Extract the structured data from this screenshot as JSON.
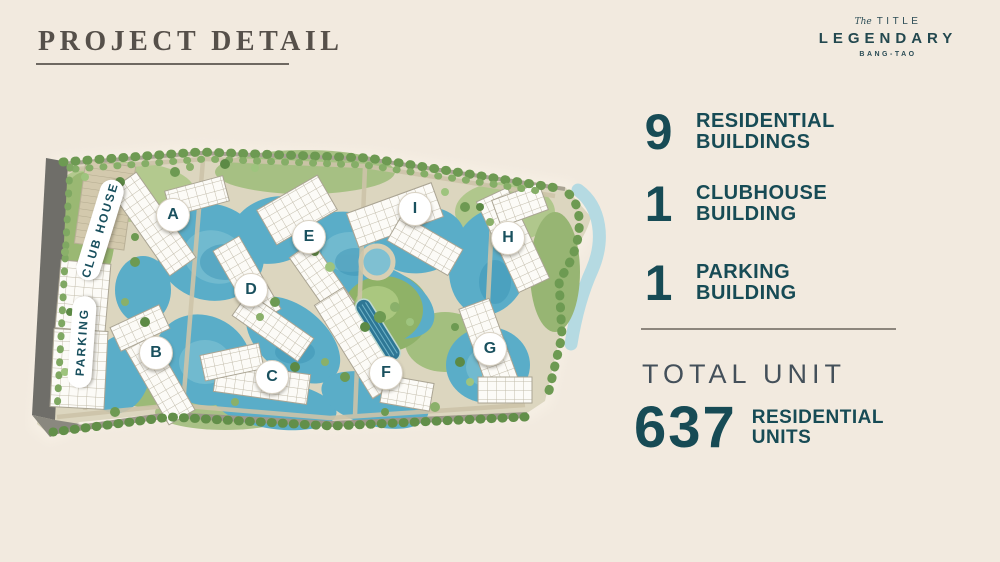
{
  "header": {
    "title": "PROJECT DETAIL"
  },
  "logo": {
    "brand_script": "The",
    "brand_name": "TITLE",
    "project_name": "LEGENDARY",
    "location": "BANG-TAO"
  },
  "map": {
    "buildings": [
      {
        "label": "A"
      },
      {
        "label": "B"
      },
      {
        "label": "C"
      },
      {
        "label": "D"
      },
      {
        "label": "E"
      },
      {
        "label": "F"
      },
      {
        "label": "G"
      },
      {
        "label": "H"
      },
      {
        "label": "I"
      }
    ],
    "facilities": [
      {
        "label": "CLUB HOUSE"
      },
      {
        "label": "PARKING"
      }
    ]
  },
  "stats": {
    "items": [
      {
        "value": "9",
        "line1": "RESIDENTIAL",
        "line2": "BUILDINGS"
      },
      {
        "value": "1",
        "line1": "CLUBHOUSE",
        "line2": "BUILDING"
      },
      {
        "value": "1",
        "line1": "PARKING",
        "line2": "BUILDING"
      }
    ],
    "total_label": "TOTAL UNIT",
    "total": {
      "value": "637",
      "line1": "RESIDENTIAL",
      "line2": "UNITS"
    }
  },
  "colors": {
    "background": "#f2eadf",
    "accent_teal": "#174b55",
    "title_gray": "#56504a",
    "water": "#5aadc8",
    "greenery": "#8ab06a"
  }
}
